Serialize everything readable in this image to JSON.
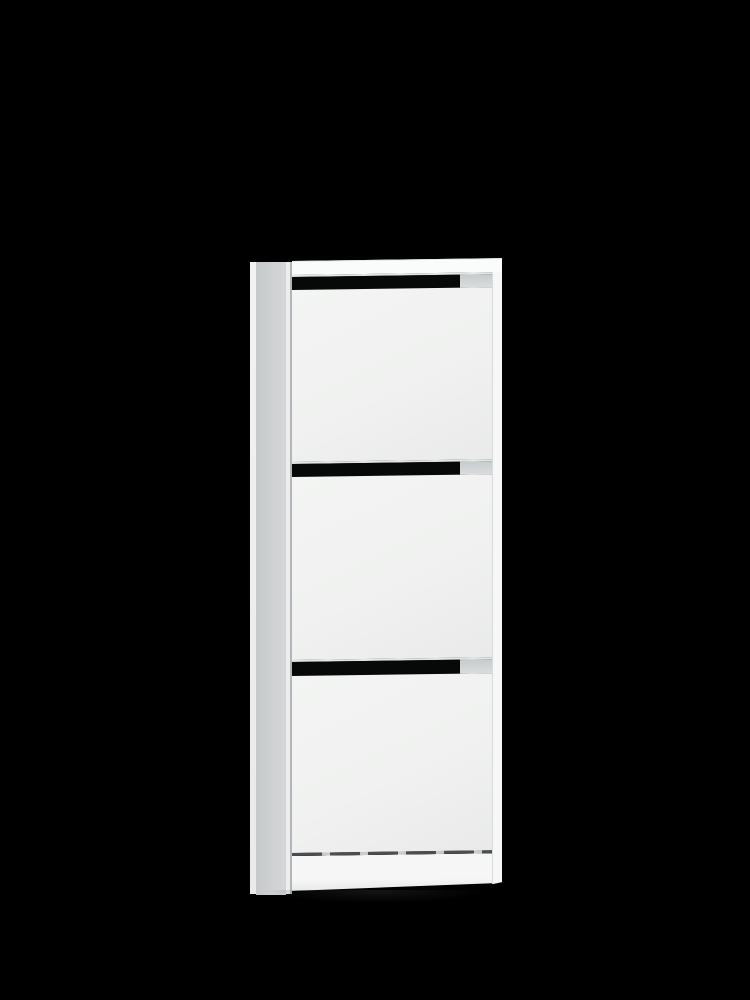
{
  "scene": {
    "description": "Studio product photo of a narrow white three-compartment tilt-out (flip-front) shoe cabinet standing on a black background",
    "background_color": "#000000",
    "object": "shoe-cabinet",
    "text_content": "none"
  },
  "cabinet": {
    "compartment_count": 3,
    "modules": [
      {
        "position": "top",
        "slot_height": 15,
        "panel_height": 172
      },
      {
        "position": "middle",
        "slot_height": 15,
        "panel_height": 183
      },
      {
        "position": "bottom",
        "slot_height": 16,
        "panel_height": 177
      }
    ],
    "slot_gap_width": 168,
    "slot_shelf_width": 32,
    "colors": {
      "background_color": "#000000",
      "front_panel": "#f0f1f0",
      "front_panel_dark": "#e9eae9",
      "top_rail": "#fafbfb",
      "right_frame": "#f6f7f7",
      "frame_line": "#d8dbdc",
      "slot_gap": "#070808",
      "slot_shelf": "#c6cbce",
      "slot_shelf_light": "#dadddd",
      "slot_edge_highlight": "#e3e6e6",
      "side_edge": "#f1f2f2",
      "side_panel_dark": "#c6c9ca",
      "side_panel_light": "#d5d6d7",
      "side_front_edge": "#ebedee",
      "side_gap_line": "#b2b6b8",
      "plinth": "#f5f6f5",
      "plinth_bottom": "#e7e9e8",
      "dash_dark": "#4a4e50",
      "dash_light": "#c9cccd",
      "floor_shadow": "rgba(35,35,35,0.6)"
    }
  }
}
